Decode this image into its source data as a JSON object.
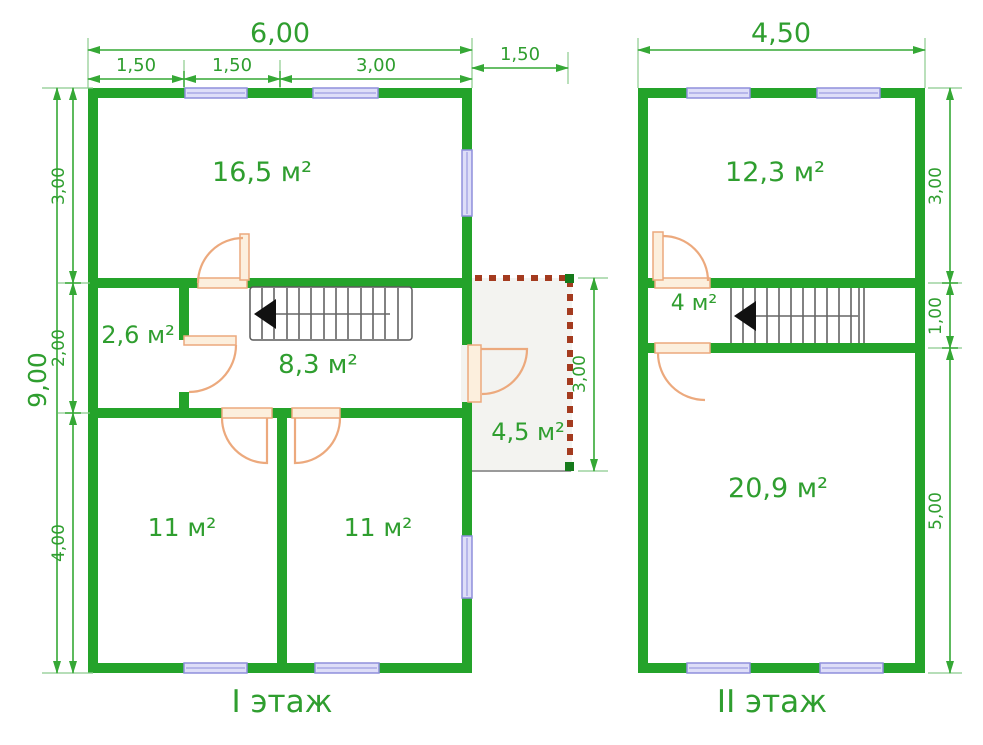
{
  "floor1": {
    "label": "I этаж",
    "rooms": {
      "living": "16,5 м²",
      "storage": "2,6 м²",
      "hall": "8,3 м²",
      "bedroom_left": "11 м²",
      "bedroom_right": "11 м²",
      "porch": "4,5 м²"
    },
    "dims": {
      "width_total": "6,00",
      "top_segments": [
        "1,50",
        "1,50",
        "3,00"
      ],
      "porch_width": "1,50",
      "height_total": "9,00",
      "left_segments": [
        "3,00",
        "2,00",
        "4,00"
      ],
      "porch_height": "3,00"
    }
  },
  "floor2": {
    "label": "II этаж",
    "rooms": {
      "bedroom": "12,3 м²",
      "landing": "4 м²",
      "main": "20,9 м²"
    },
    "dims": {
      "width_total": "4,50",
      "right_segments": [
        "3,00",
        "1,00",
        "5,00"
      ]
    }
  },
  "colors": {
    "wall": "#24a32a",
    "dimension": "#35a835",
    "text": "#2f9e2f",
    "window_fill": "#dedef8",
    "window_border": "#8f8fdc",
    "door": "#eca97d",
    "porch_dash": "#a43b1f"
  }
}
